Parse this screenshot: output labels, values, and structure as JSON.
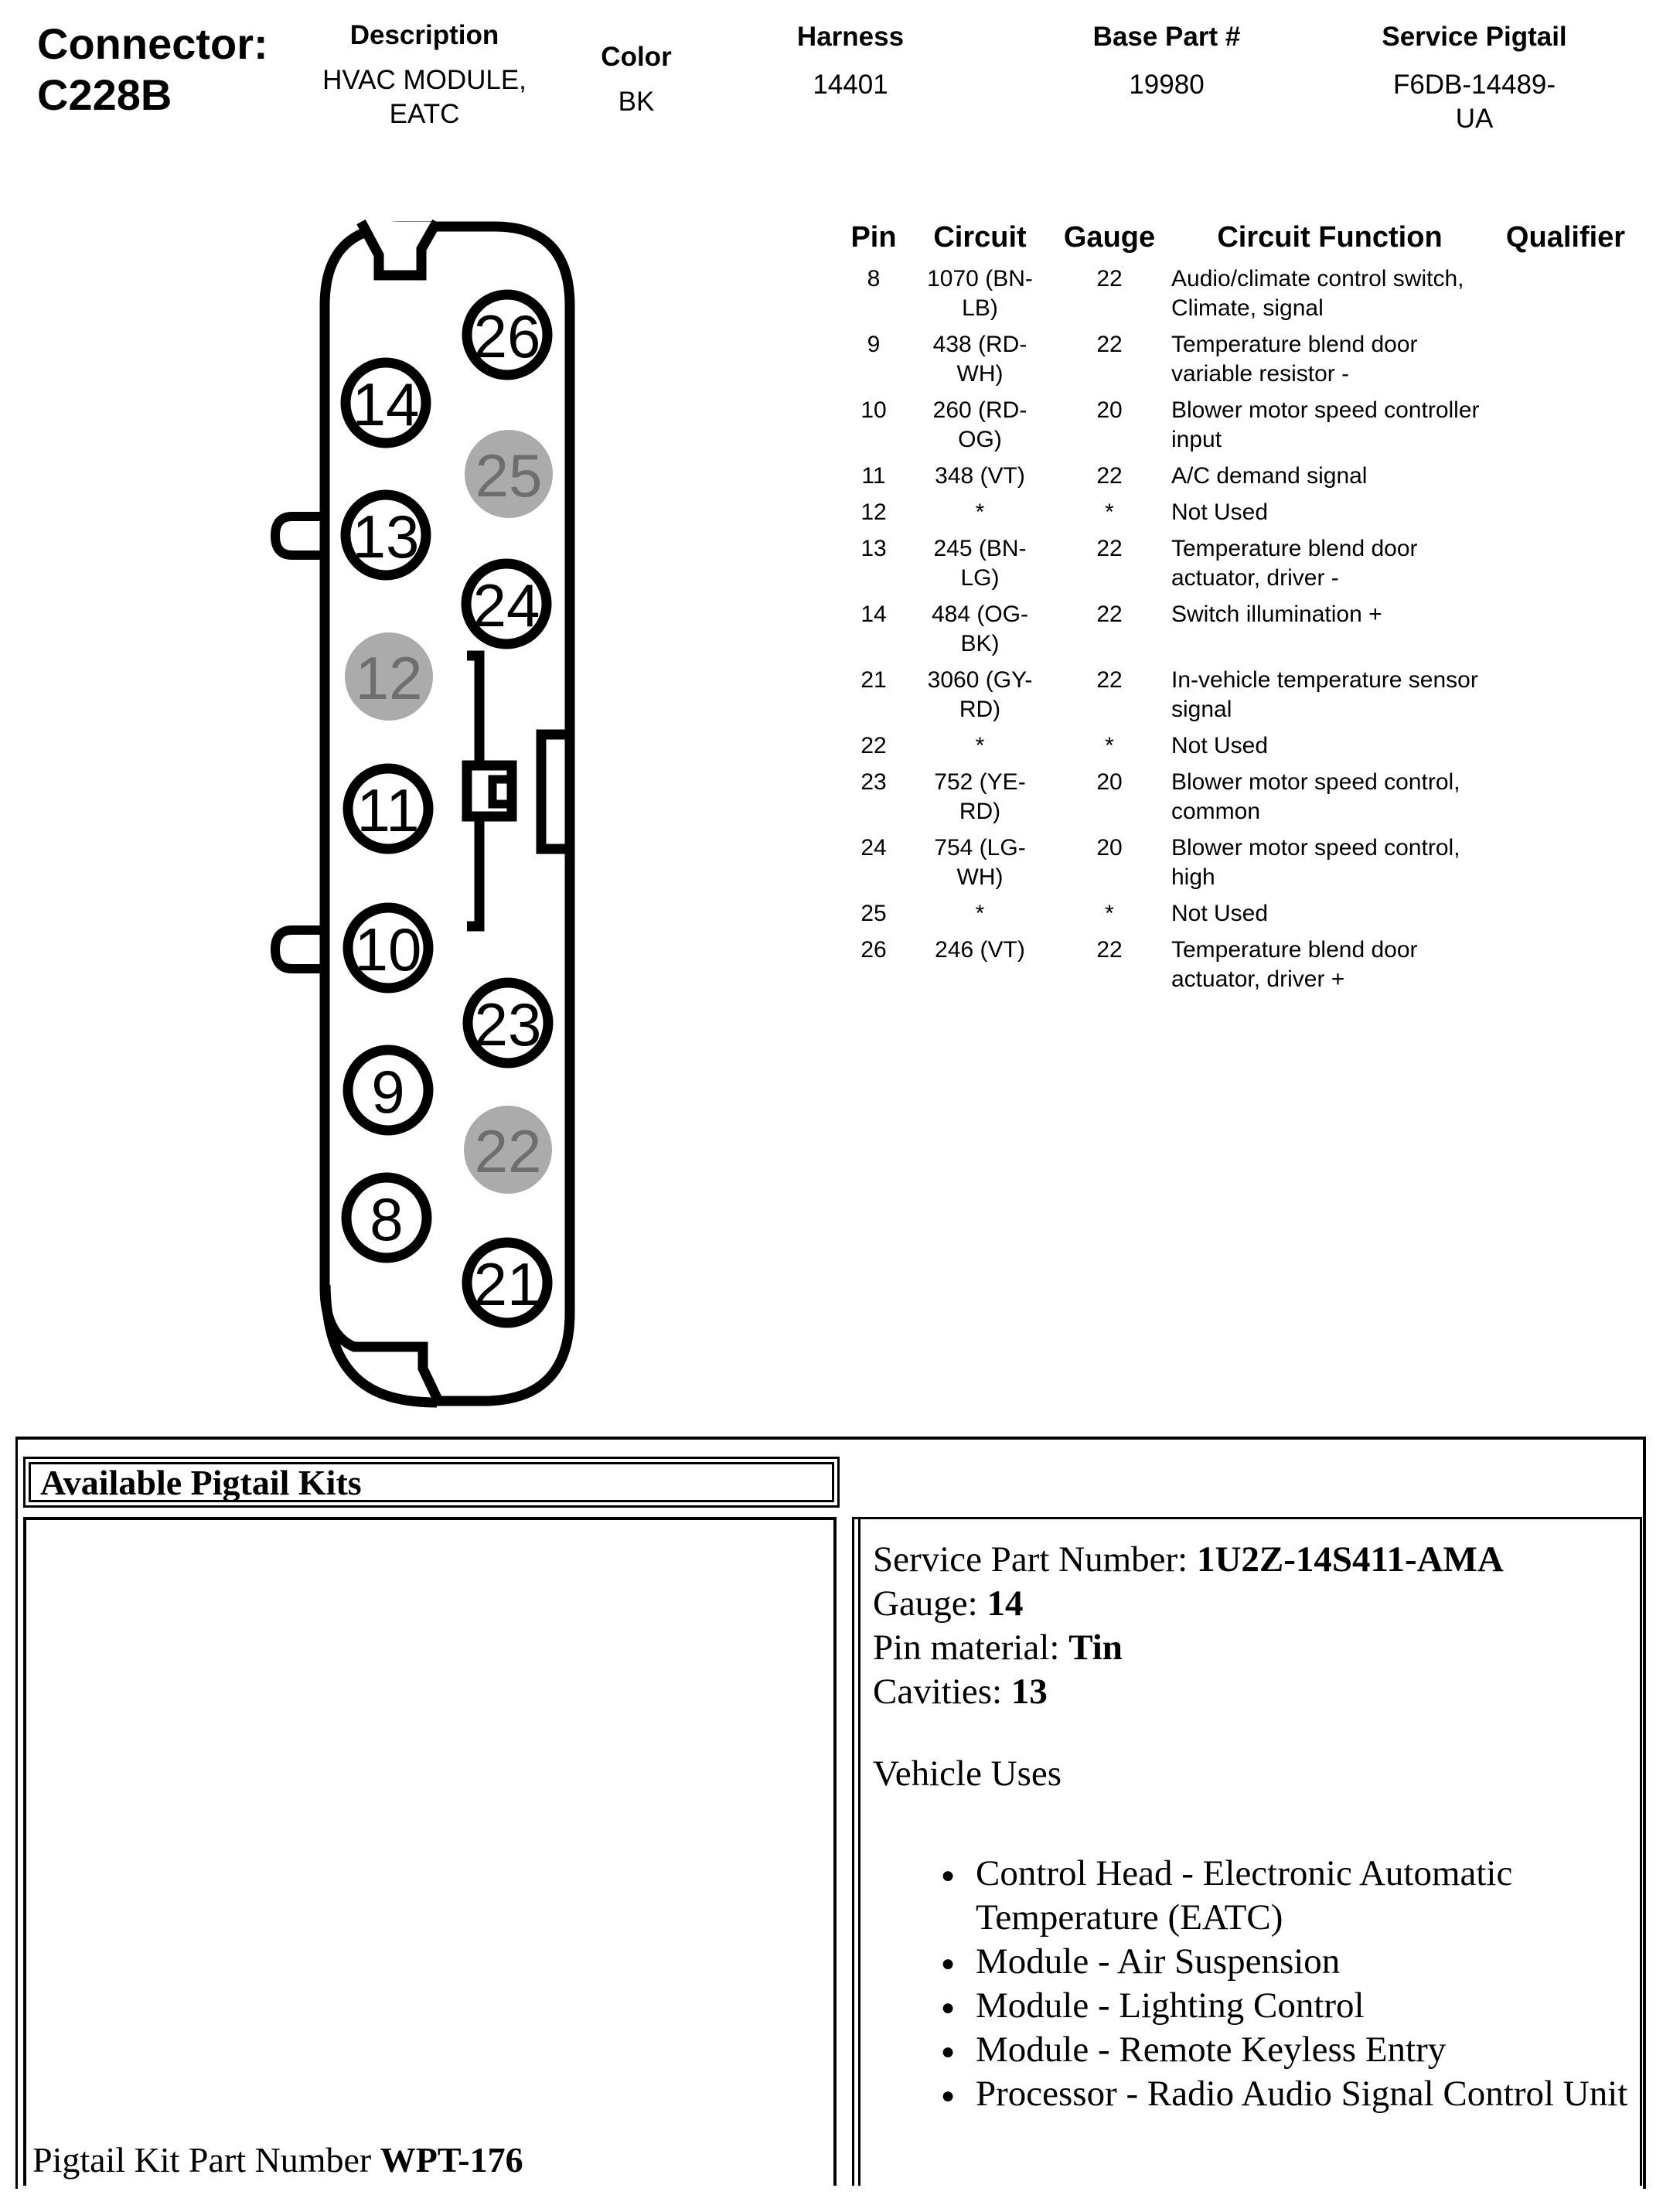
{
  "header": {
    "connector_label": "Connector:",
    "connector_id": "C228B",
    "fields": [
      {
        "label": "Description",
        "value": "HVAC MODULE, EATC"
      },
      {
        "label": "Color",
        "value": "BK"
      },
      {
        "label": "Harness",
        "value": "14401"
      },
      {
        "label": "Base Part #",
        "value": "19980"
      },
      {
        "label": "Service Pigtail",
        "value": "F6DB-14489-UA"
      }
    ]
  },
  "diagram": {
    "pins": [
      {
        "number": "26",
        "filled": false
      },
      {
        "number": "14",
        "filled": false
      },
      {
        "number": "25",
        "filled": true
      },
      {
        "number": "13",
        "filled": false
      },
      {
        "number": "24",
        "filled": false
      },
      {
        "number": "12",
        "filled": true
      },
      {
        "number": "11",
        "filled": false
      },
      {
        "number": "10",
        "filled": false
      },
      {
        "number": "23",
        "filled": false
      },
      {
        "number": "9",
        "filled": false
      },
      {
        "number": "22",
        "filled": true
      },
      {
        "number": "8",
        "filled": false
      },
      {
        "number": "21",
        "filled": false
      }
    ],
    "filled_color": "#ababab",
    "filled_text_color": "#6e6e6e",
    "outline_color": "#000000"
  },
  "pin_table": {
    "headers": [
      "Pin",
      "Circuit",
      "Gauge",
      "Circuit Function",
      "Qualifier"
    ],
    "rows": [
      {
        "pin": "8",
        "circuit": "1070 (BN-LB)",
        "gauge": "22",
        "function": "Audio/climate control switch, Climate, signal",
        "qualifier": ""
      },
      {
        "pin": "9",
        "circuit": "438 (RD-WH)",
        "gauge": "22",
        "function": "Temperature blend door variable resistor -",
        "qualifier": ""
      },
      {
        "pin": "10",
        "circuit": "260 (RD-OG)",
        "gauge": "20",
        "function": "Blower motor speed controller input",
        "qualifier": ""
      },
      {
        "pin": "11",
        "circuit": "348 (VT)",
        "gauge": "22",
        "function": "A/C demand signal",
        "qualifier": ""
      },
      {
        "pin": "12",
        "circuit": "*",
        "gauge": "*",
        "function": "Not Used",
        "qualifier": ""
      },
      {
        "pin": "13",
        "circuit": "245 (BN-LG)",
        "gauge": "22",
        "function": "Temperature blend door actuator, driver -",
        "qualifier": ""
      },
      {
        "pin": "14",
        "circuit": "484 (OG-BK)",
        "gauge": "22",
        "function": "Switch illumination +",
        "qualifier": ""
      },
      {
        "pin": "21",
        "circuit": "3060 (GY-RD)",
        "gauge": "22",
        "function": "In-vehicle temperature sensor signal",
        "qualifier": ""
      },
      {
        "pin": "22",
        "circuit": "*",
        "gauge": "*",
        "function": "Not Used",
        "qualifier": ""
      },
      {
        "pin": "23",
        "circuit": "752 (YE-RD)",
        "gauge": "20",
        "function": "Blower motor speed control, common",
        "qualifier": ""
      },
      {
        "pin": "24",
        "circuit": "754 (LG-WH)",
        "gauge": "20",
        "function": "Blower motor speed control, high",
        "qualifier": ""
      },
      {
        "pin": "25",
        "circuit": "*",
        "gauge": "*",
        "function": "Not Used",
        "qualifier": ""
      },
      {
        "pin": "26",
        "circuit": "246 (VT)",
        "gauge": "22",
        "function": "Temperature blend door actuator, driver +",
        "qualifier": ""
      }
    ]
  },
  "pigtail": {
    "title": "Available Pigtail Kits",
    "kit_label": "Pigtail Kit Part Number",
    "kit_number": "WPT-176",
    "details": [
      {
        "label": "Service Part Number:",
        "value": "1U2Z-14S411-AMA"
      },
      {
        "label": "Gauge:",
        "value": "14"
      },
      {
        "label": "Pin material:",
        "value": "Tin"
      },
      {
        "label": "Cavities:",
        "value": "13"
      }
    ],
    "vehicle_uses_label": "Vehicle Uses",
    "vehicle_uses": [
      "Control Head - Electronic Automatic Temperature (EATC)",
      "Module - Air Suspension",
      "Module - Lighting Control",
      "Module - Remote Keyless Entry",
      "Processor - Radio Audio Signal Control Unit"
    ]
  }
}
